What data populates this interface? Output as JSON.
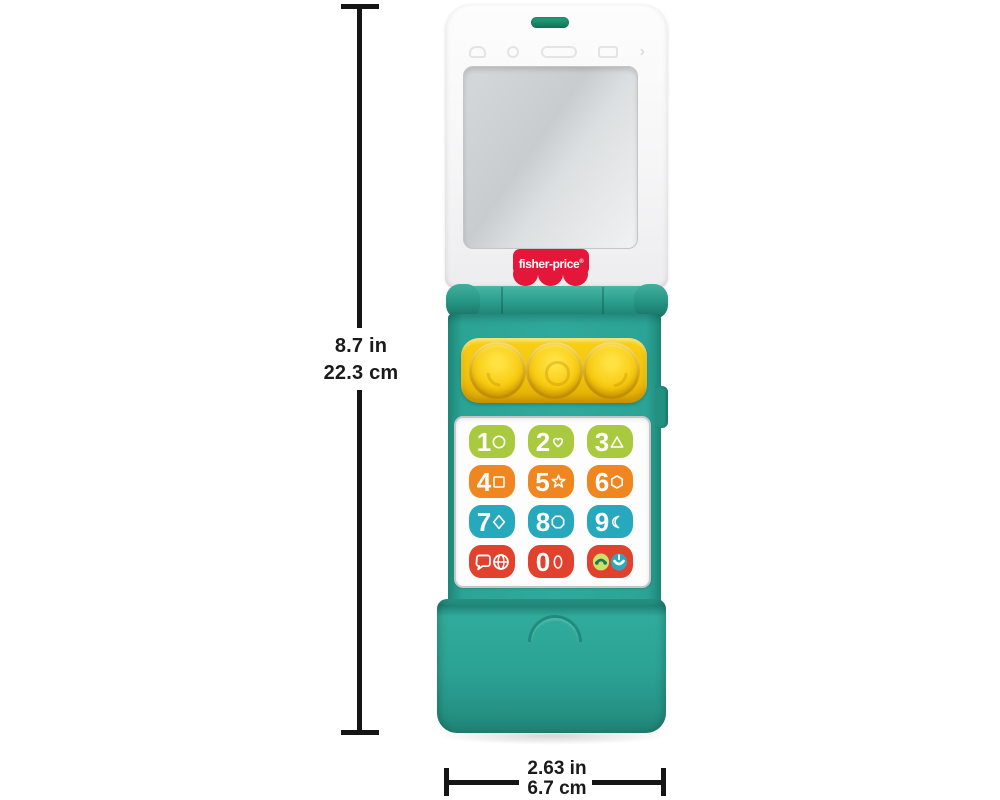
{
  "dimension_labels": {
    "height": {
      "inches": "8.7 in",
      "centimeters": "22.3 cm"
    },
    "width": {
      "inches": "2.63 in",
      "centimeters": "6.7 cm"
    }
  },
  "brand": {
    "logo_text": "fisher-price",
    "registered_mark": "®"
  },
  "keypad": {
    "buttons": [
      {
        "label": "1",
        "shape": "circle",
        "color": "#a9c93e"
      },
      {
        "label": "2",
        "shape": "heart",
        "color": "#a9c93e"
      },
      {
        "label": "3",
        "shape": "triangle",
        "color": "#a9c93e"
      },
      {
        "label": "4",
        "shape": "square",
        "color": "#f0861f"
      },
      {
        "label": "5",
        "shape": "star",
        "color": "#f0861f"
      },
      {
        "label": "6",
        "shape": "hexagon",
        "color": "#f0861f"
      },
      {
        "label": "7",
        "shape": "diamond",
        "color": "#27a9bd"
      },
      {
        "label": "8",
        "shape": "octagon",
        "color": "#27a9bd"
      },
      {
        "label": "9",
        "shape": "crescent-moon",
        "color": "#27a9bd"
      },
      {
        "label": "",
        "shape": "speech-bubble-globe",
        "color": "#e2412d"
      },
      {
        "label": "0",
        "shape": "oval",
        "color": "#e2412d"
      },
      {
        "label": "",
        "shape": "call-answer-hangup",
        "color": "#e2412d"
      }
    ]
  },
  "phone": {
    "body_color": "#2ba495",
    "roller_panel_color": "#f2c30b",
    "roller_button_count": 3,
    "indicator_color": "#1d9e7b",
    "logo_badge_color": "#e4173b",
    "mirror_screen": true
  }
}
